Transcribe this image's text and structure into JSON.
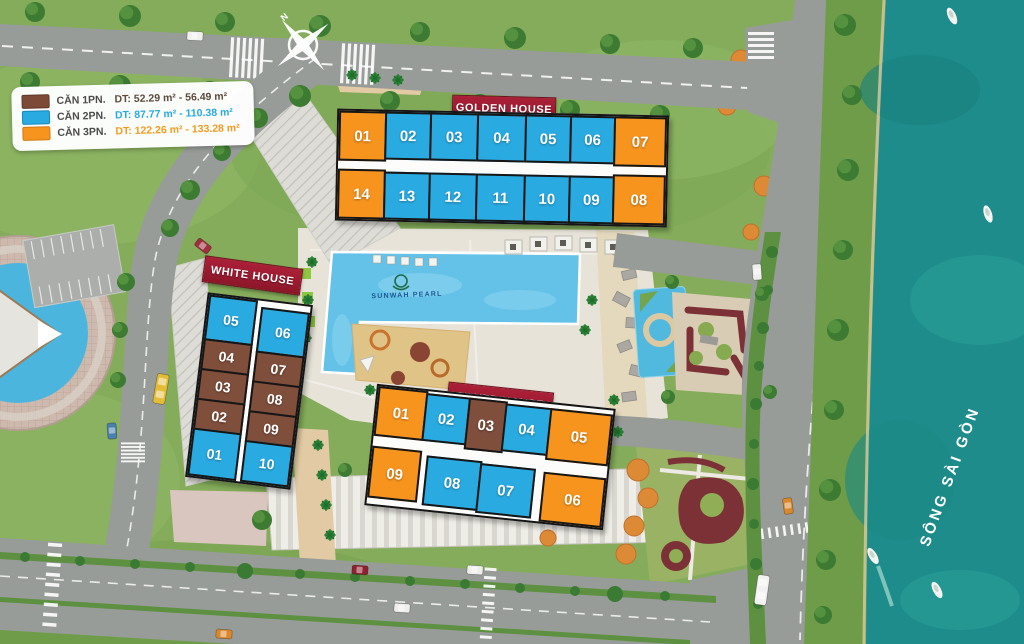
{
  "project": {
    "name": "SUNWAH PEARL"
  },
  "compass": {
    "north_label": "N"
  },
  "river": {
    "name": "SÔNG SÀI GÒN"
  },
  "legend": {
    "items": [
      {
        "label": "CĂN 1PN.",
        "area": "DT: 52.29 m² - 56.49 m²",
        "type": "1PN",
        "color": "#7c4a37"
      },
      {
        "label": "CĂN 2PN.",
        "area": "DT: 87.77 m² - 110.38 m²",
        "type": "2PN",
        "color": "#29abe2"
      },
      {
        "label": "CĂN 3PN.",
        "area": "DT: 122.26 m² - 133.28 m²",
        "type": "3PN",
        "color": "#f7941e"
      }
    ]
  },
  "buildings": {
    "golden": {
      "name": "GOLDEN HOUSE",
      "units": [
        {
          "label": "01",
          "type": "3PN"
        },
        {
          "label": "02",
          "type": "2PN"
        },
        {
          "label": "03",
          "type": "2PN"
        },
        {
          "label": "04",
          "type": "2PN"
        },
        {
          "label": "05",
          "type": "2PN"
        },
        {
          "label": "06",
          "type": "2PN"
        },
        {
          "label": "07",
          "type": "3PN"
        },
        {
          "label": "14",
          "type": "3PN"
        },
        {
          "label": "13",
          "type": "2PN"
        },
        {
          "label": "12",
          "type": "2PN"
        },
        {
          "label": "11",
          "type": "2PN"
        },
        {
          "label": "10",
          "type": "2PN"
        },
        {
          "label": "09",
          "type": "2PN"
        },
        {
          "label": "08",
          "type": "3PN"
        }
      ]
    },
    "white": {
      "name": "WHITE HOUSE",
      "units": [
        {
          "label": "05",
          "type": "2PN"
        },
        {
          "label": "04",
          "type": "1PN"
        },
        {
          "label": "03",
          "type": "1PN"
        },
        {
          "label": "02",
          "type": "1PN"
        },
        {
          "label": "01",
          "type": "2PN"
        },
        {
          "label": "06",
          "type": "2PN"
        },
        {
          "label": "07",
          "type": "1PN"
        },
        {
          "label": "08",
          "type": "1PN"
        },
        {
          "label": "09",
          "type": "1PN"
        },
        {
          "label": "10",
          "type": "2PN"
        }
      ]
    },
    "silver": {
      "name": "SILVER HOUSE",
      "units": [
        {
          "label": "01",
          "type": "3PN"
        },
        {
          "label": "02",
          "type": "2PN"
        },
        {
          "label": "03",
          "type": "1PN"
        },
        {
          "label": "04",
          "type": "2PN"
        },
        {
          "label": "05",
          "type": "3PN"
        },
        {
          "label": "09",
          "type": "3PN"
        },
        {
          "label": "08",
          "type": "2PN"
        },
        {
          "label": "07",
          "type": "2PN"
        },
        {
          "label": "06",
          "type": "3PN"
        }
      ]
    }
  },
  "colors": {
    "unit_1pn": "#7c4a37",
    "unit_2pn": "#29abe2",
    "unit_3pn": "#f7941e",
    "banner": "#9e1d33",
    "river": "#1e8c8a",
    "grass": "#84ac5a",
    "road": "#989c98"
  }
}
